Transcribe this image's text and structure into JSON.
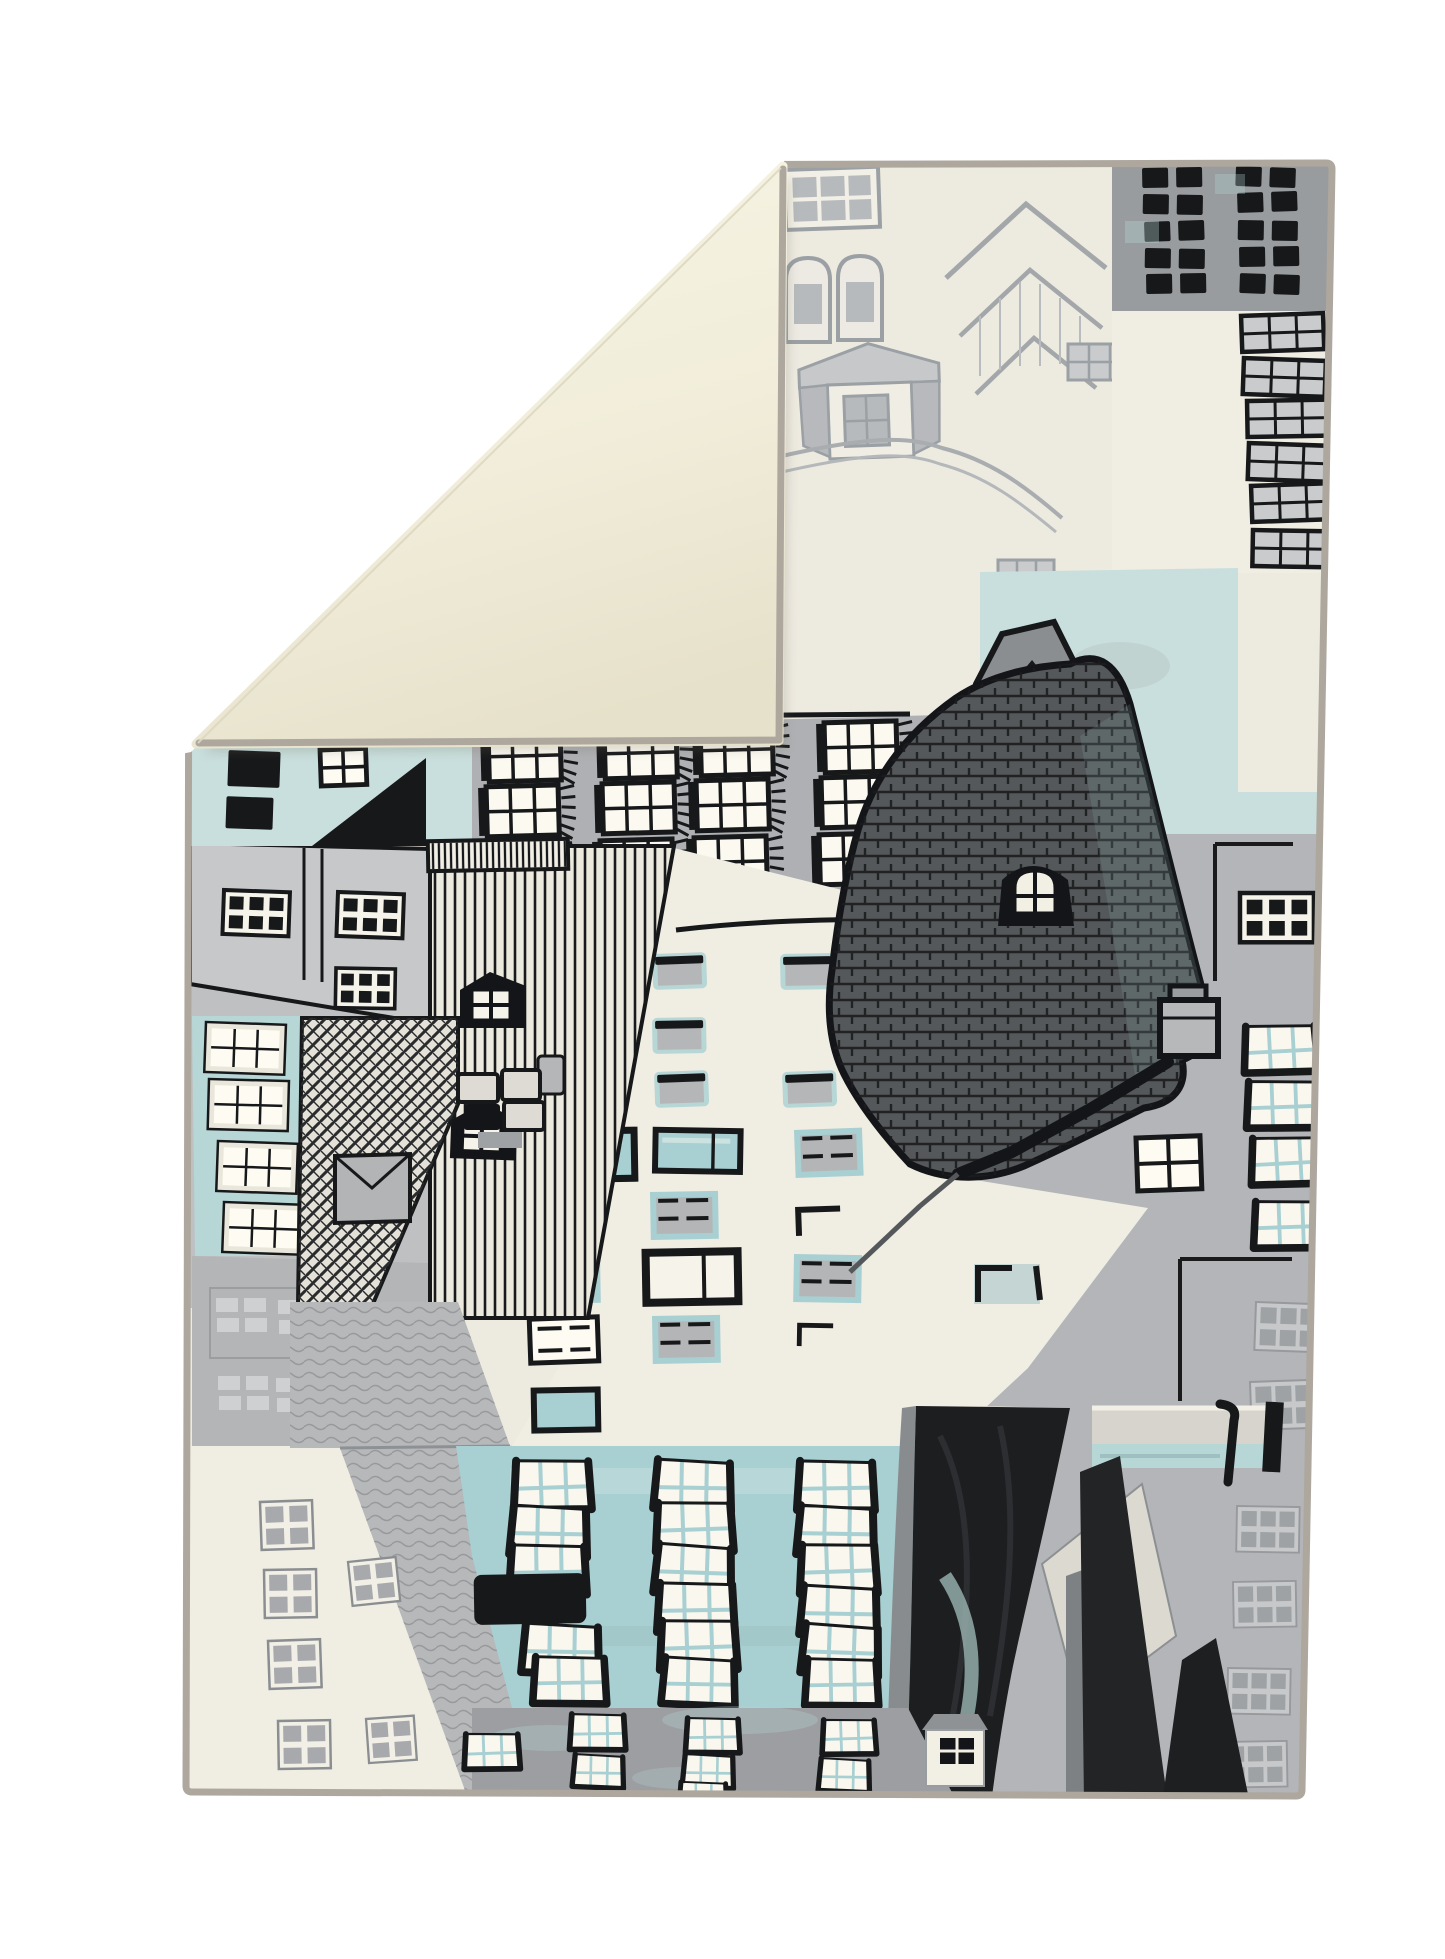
{
  "scene": {
    "type": "product-photo",
    "subject": "Flat-woven area rug with hand-drawn cityscape rooftop print, top-left corner folded over showing plain cream backing, on a white studio background",
    "print_style": "sketchy ink and watercolor buildings, rooftops and windows",
    "no_visible_text": true
  },
  "palette": {
    "page_bg": "#ffffff",
    "flap_cream_light": "#f7f4e4",
    "flap_cream": "#f1edda",
    "flap_cream_shade": "#e6e1ca",
    "crease_edge": "#dcd7c1",
    "binding_grey": "#ada79e",
    "print_bg": "#edeae0",
    "offwhite": "#f0ede3",
    "light_grey": "#c7c8ca",
    "mid_grey": "#b3b5b8",
    "block_grey": "#999c9f",
    "dark_grey": "#7b7e81",
    "sketch_grey": "#9aa0a4",
    "roof_dark": "#54585a",
    "near_black": "#17181a",
    "aqua": "#b7d6d6",
    "aqua_deep": "#a8cfd1",
    "aqua_pale": "#c9dfdd",
    "pane_grey": "#abadaf",
    "ghost_grey": "#c3c5c7",
    "stripe_bg": "#eceadf",
    "shadow": "#6f6a5c"
  },
  "elements": {
    "rug": "printed rug front face",
    "flap": "folded-over corner showing cream rug backing",
    "binding": "grey whip-stitched edge binding",
    "features": [
      "grey apartment block with black window pairs (top right)",
      "white strip with rows of black-framed windows (right edge)",
      "aqua sky patches",
      "sketched light-grey rooftops and bay windows (top centre)",
      "grey facade with fringed sash windows",
      "corner turret with white gable",
      "large dark shingled roof with dormer and chimney",
      "black clapboard-striped house with gabled dormers",
      "cream high-rise with aqua-trimmed windows",
      "aqua facade with rows of black-bracket windows",
      "black painted roof wedges (bottom right)",
      "steep cross-hatched black roof and soft grey roofs (bottom left)",
      "aqua house with white windows (left edge)",
      "small white house and grey ground band (bottom)"
    ]
  }
}
